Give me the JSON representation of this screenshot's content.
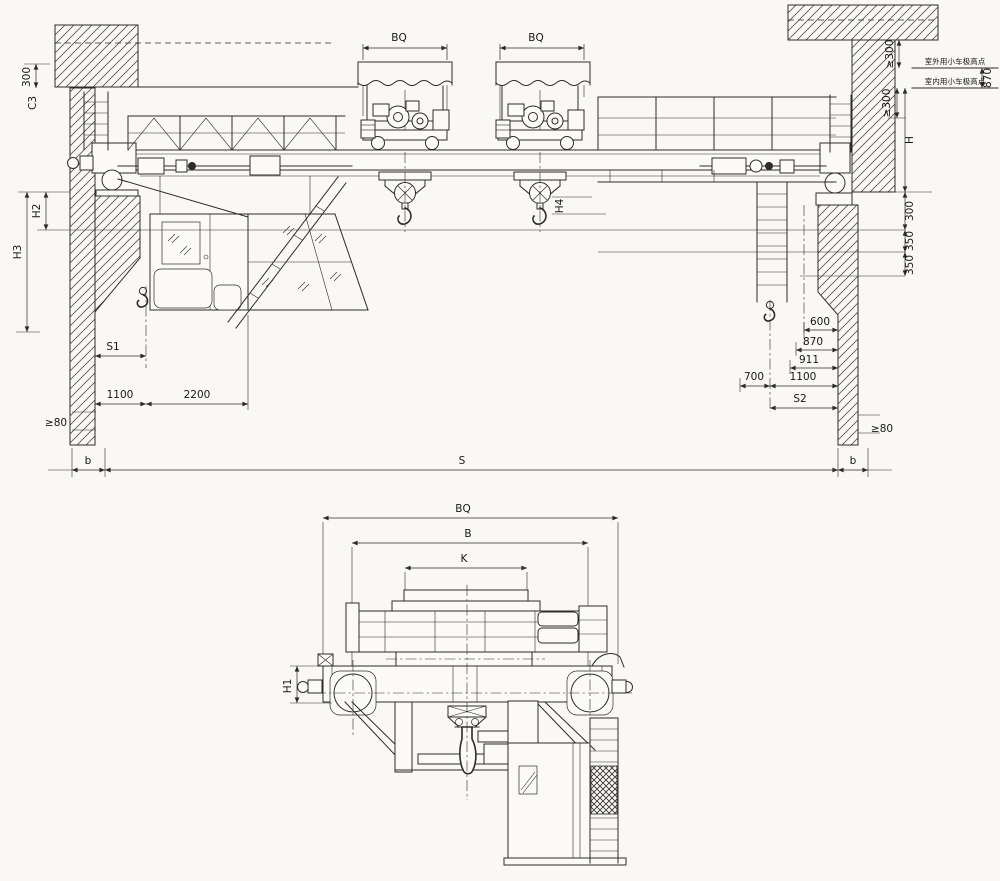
{
  "fv": {
    "bq_left": "BQ",
    "bq_right": "BQ",
    "dim300_top_left": "300",
    "c_label": "C3",
    "h2": "H2",
    "h3": "H3",
    "s1": "S1",
    "dim1100_left": "1100",
    "dim2200": "2200",
    "min80_left": "≥80",
    "b_left": "b",
    "span": "S",
    "b_right": "b",
    "min80_right": "≥80",
    "s2": "S2",
    "dim700": "700",
    "dim1100_right": "1100",
    "dim911": "911",
    "dim870_right": "870",
    "dim600": "600",
    "dim300_right": "300",
    "dim350_a": "350",
    "dim350_b": "350",
    "h4": "H4",
    "h": "H",
    "min300_upper": "≥300",
    "min300_lower": "≥300",
    "dim870_top": "870",
    "note_outdoor": "室外用小车极高点",
    "note_indoor": "室内用小车极高点"
  },
  "sv": {
    "bq": "BQ",
    "b": "B",
    "k": "K",
    "h1": "H1"
  }
}
